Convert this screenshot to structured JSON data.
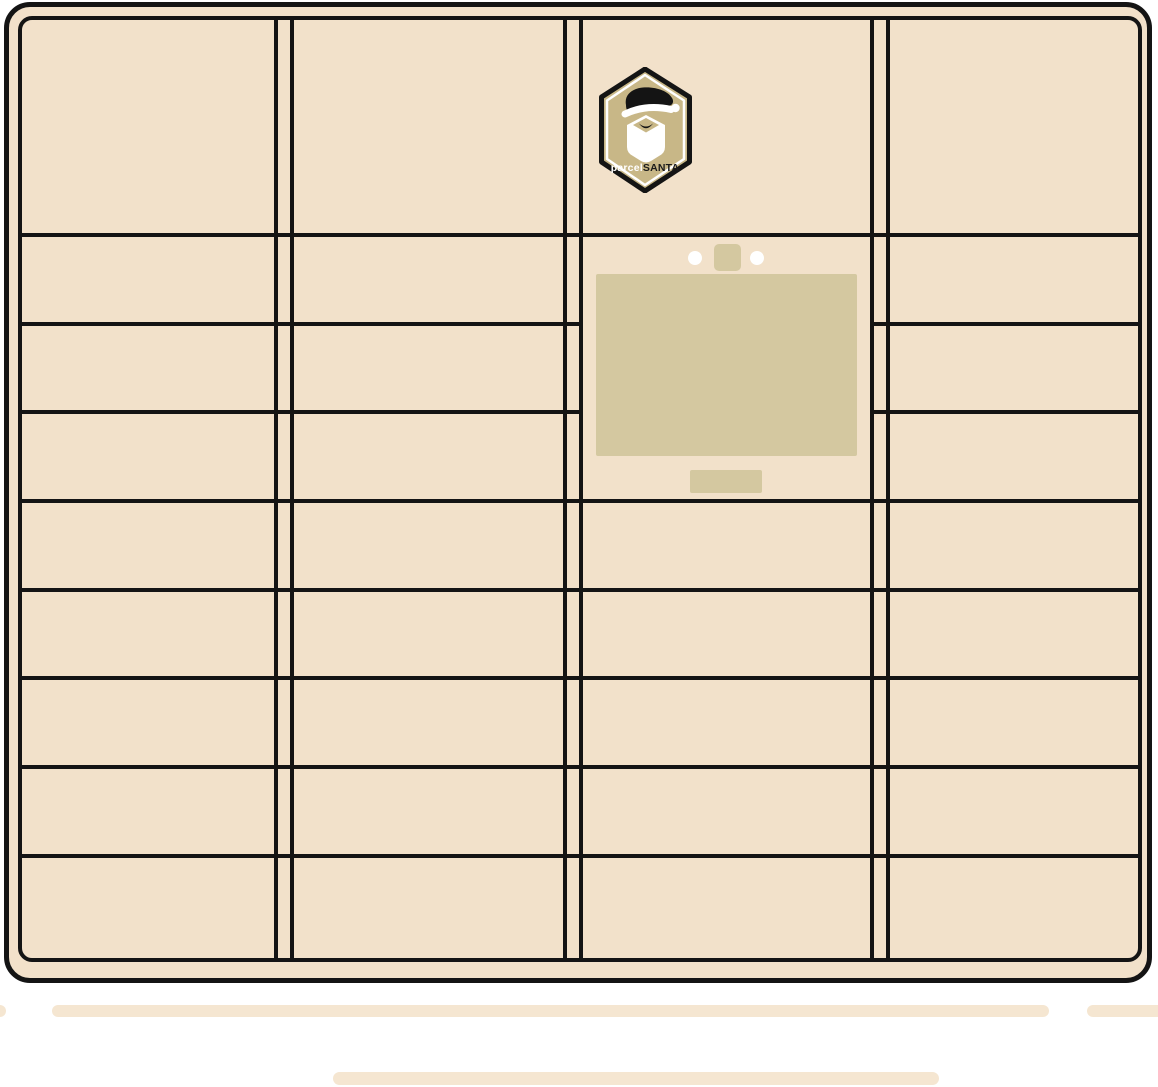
{
  "illustration": {
    "brand": {
      "prefix": "parcel",
      "suffix": "SANTA"
    },
    "colors": {
      "background": "#ffffff",
      "cabinet_fill": "#f2e1ca",
      "outline": "#141414",
      "screen_fill": "#d4c8a0",
      "badge_fill": "#c8b787",
      "accent_white": "#ffffff",
      "ground_bar_fill": "#f5e6d1"
    },
    "cabinet": {
      "columns": [
        {
          "name": "column-1",
          "compartments": 9
        },
        {
          "name": "column-2",
          "compartments": 9
        },
        {
          "name": "column-3",
          "compartments": 5,
          "has_logo_panel": true,
          "has_terminal": true
        },
        {
          "name": "column-4",
          "compartments": 9
        }
      ],
      "terminal": {
        "indicator_lights": 2,
        "camera_blocks": 1,
        "screens": 1,
        "dispenser_slots": 1
      }
    },
    "ground": {
      "bar_count": 4
    }
  }
}
